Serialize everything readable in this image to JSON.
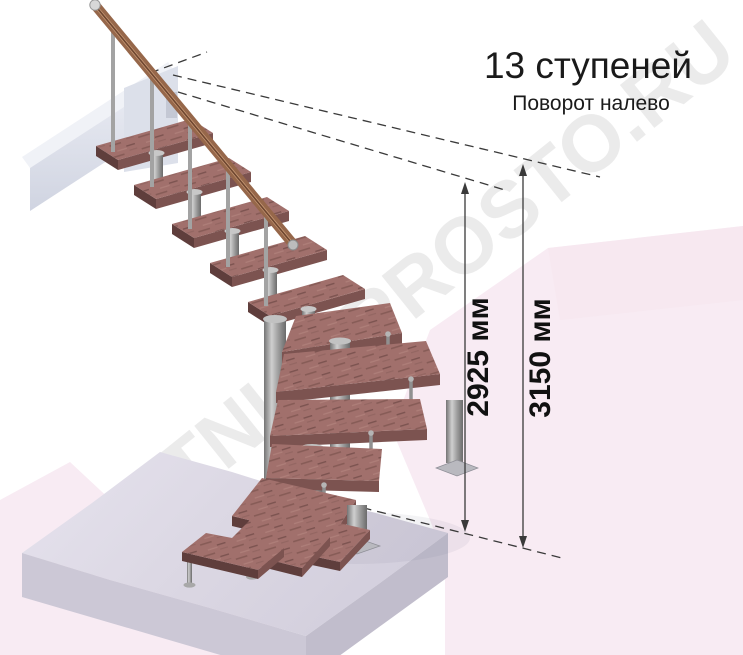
{
  "header": {
    "title": "13 ступеней",
    "subtitle": "Поворот налево"
  },
  "dimensions": {
    "inner_height_label": "2925 мм",
    "outer_height_label": "3150 мм"
  },
  "watermark": {
    "text": "LESTNICI-PROSTO.RU"
  },
  "illustration": {
    "description": "modular staircase with 13 steps turning left",
    "step_count": "13"
  },
  "colors": {
    "wood_tread": "#a1706c",
    "wood_tread_front": "#7c5350",
    "handrail": "#96674a",
    "metal_column": "#9a9a9a",
    "floor_slab": "#dbd7e3",
    "watermark_pink": "#f8ebf3",
    "watermark_gray": "#e0e0e0",
    "annotation": "#3a3a3a",
    "text": "#1a1a1a"
  }
}
